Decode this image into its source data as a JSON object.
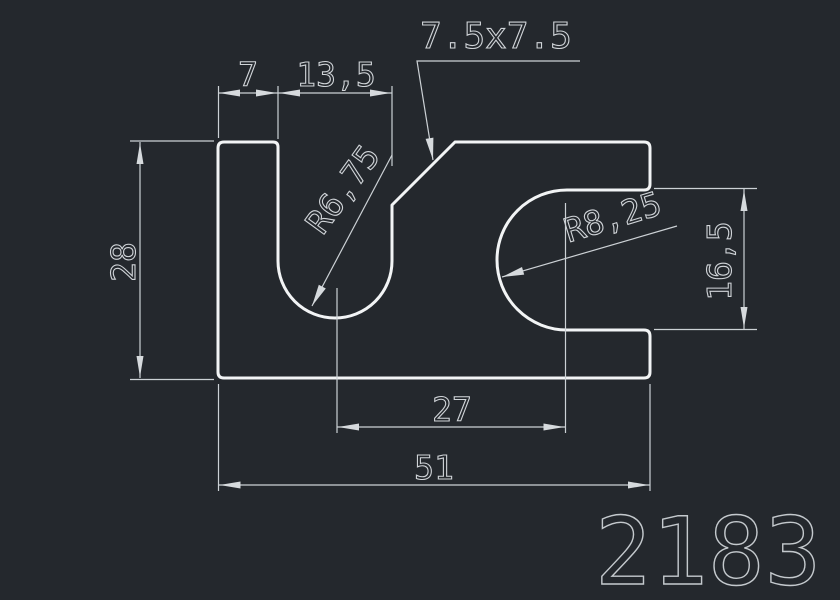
{
  "drawing": {
    "part_number": "2183",
    "dimensions": {
      "top_left_width": "7",
      "slot_width": "13,5",
      "chamfer_size": "7.5x7.5",
      "overall_height": "28",
      "fork_opening_height": "16,5",
      "slot_radius": "R6,75",
      "fork_radius": "R8,25",
      "slot_to_fork_center": "27",
      "overall_width": "51"
    },
    "colors": {
      "background": "#24282d",
      "part_outline": "#f2f4f5",
      "dimension_lines": "#ccd1d5",
      "part_number_color": "#c4c9cd"
    }
  }
}
